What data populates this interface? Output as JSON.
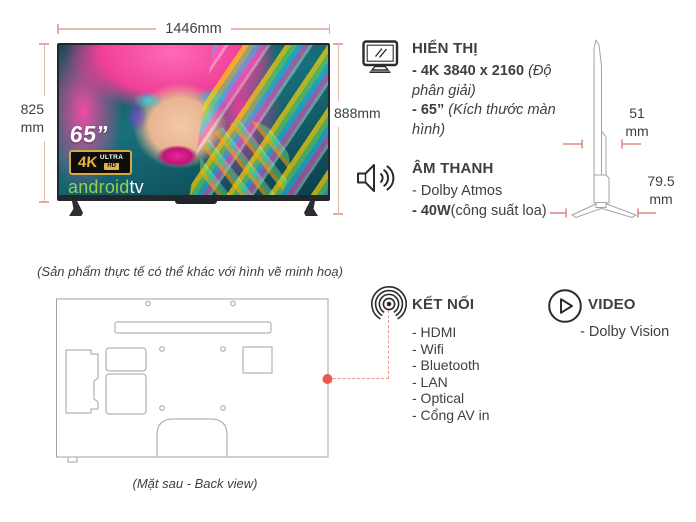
{
  "front_view": {
    "width_label": "1446mm",
    "height_value": "825",
    "height_unit": "mm",
    "total_height_label": "888mm",
    "screen_overlay": {
      "size_label": "65”",
      "badge_4k": "4K",
      "badge_ultra": "ULTRA",
      "badge_hd": "HD",
      "brand_android": "android",
      "brand_tv": "tv"
    }
  },
  "side_view": {
    "depth_value": "51",
    "depth_unit": "mm",
    "base_depth_value": "79.5",
    "base_depth_unit": "mm"
  },
  "specs": {
    "display": {
      "title": "HIỂN THỊ",
      "items": [
        {
          "bold": "- 4K 3840 x 2160 ",
          "regular": "",
          "italic": "(Độ phân giải)"
        },
        {
          "bold": "- 65” ",
          "regular": "",
          "italic": "(Kích thước màn hình)"
        }
      ]
    },
    "audio": {
      "title": "ÂM THANH",
      "items": [
        {
          "bold": "",
          "regular": "- Dolby Atmos",
          "italic": ""
        },
        {
          "bold": "- 40W",
          "regular": "(công suất loa)",
          "italic": ""
        }
      ]
    },
    "connectivity": {
      "title": "KẾT NỐI",
      "items": [
        "- HDMI",
        "- Wifi",
        "- Bluetooth",
        "- LAN",
        "- Optical",
        "- Cổng AV in"
      ]
    },
    "video": {
      "title": "VIDEO",
      "items": [
        "- Dolby Vision"
      ]
    }
  },
  "captions": {
    "disclaimer": "(Sản phẩm thực tế có thể khác với hình vẽ minh hoạ)",
    "back_view": "(Mặt sau - Back view)"
  },
  "icons": {
    "display": "monitor-icon",
    "audio": "speaker-icon",
    "connectivity": "broadcast-icon",
    "video": "play-icon"
  },
  "colors": {
    "text": "#3f3f3f",
    "dimension_line": "#e7b9b3",
    "dimension_tick": "#dd8c84",
    "connector_red": "#ea5952",
    "android_green": "#9ccc53",
    "badge_gold": "#e8b43a"
  }
}
